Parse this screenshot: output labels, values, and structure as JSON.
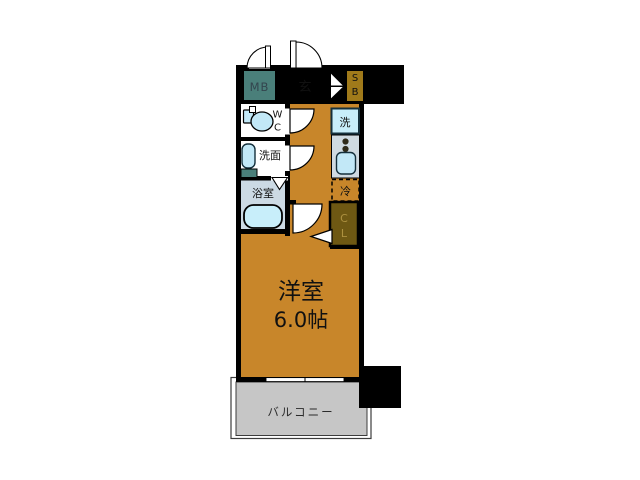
{
  "plan": {
    "type": "apartment-floorplan",
    "labels": {
      "meter_box": "MB",
      "entrance": "玄",
      "shoe_box": [
        "S",
        "B"
      ],
      "wc": [
        "W",
        "C"
      ],
      "washroom": "洗面",
      "bathroom": "浴室",
      "washing_machine": "洗",
      "refrigerator": "冷",
      "closet": [
        "C",
        "L"
      ],
      "main_room_name": "洋室",
      "main_room_size": "6.0帖",
      "balcony": "バルコニー"
    },
    "colors": {
      "wall": "#000000",
      "floor": "#c8862a",
      "meter_box": "#4a7f7a",
      "entrance_floor": "#c5c5c5",
      "shoe_box": "#a07a1a",
      "closet": "#6e5813",
      "closet_text": "#ad9140",
      "fixture_blue": "#c2e8f7",
      "washer_blue": "#c8eefa",
      "bathroom_floor": "#ccdae4",
      "counter": "#cfdae1",
      "balcony_floor": "#c6c6c6",
      "pipe_teal": "#4a7f7a"
    }
  }
}
